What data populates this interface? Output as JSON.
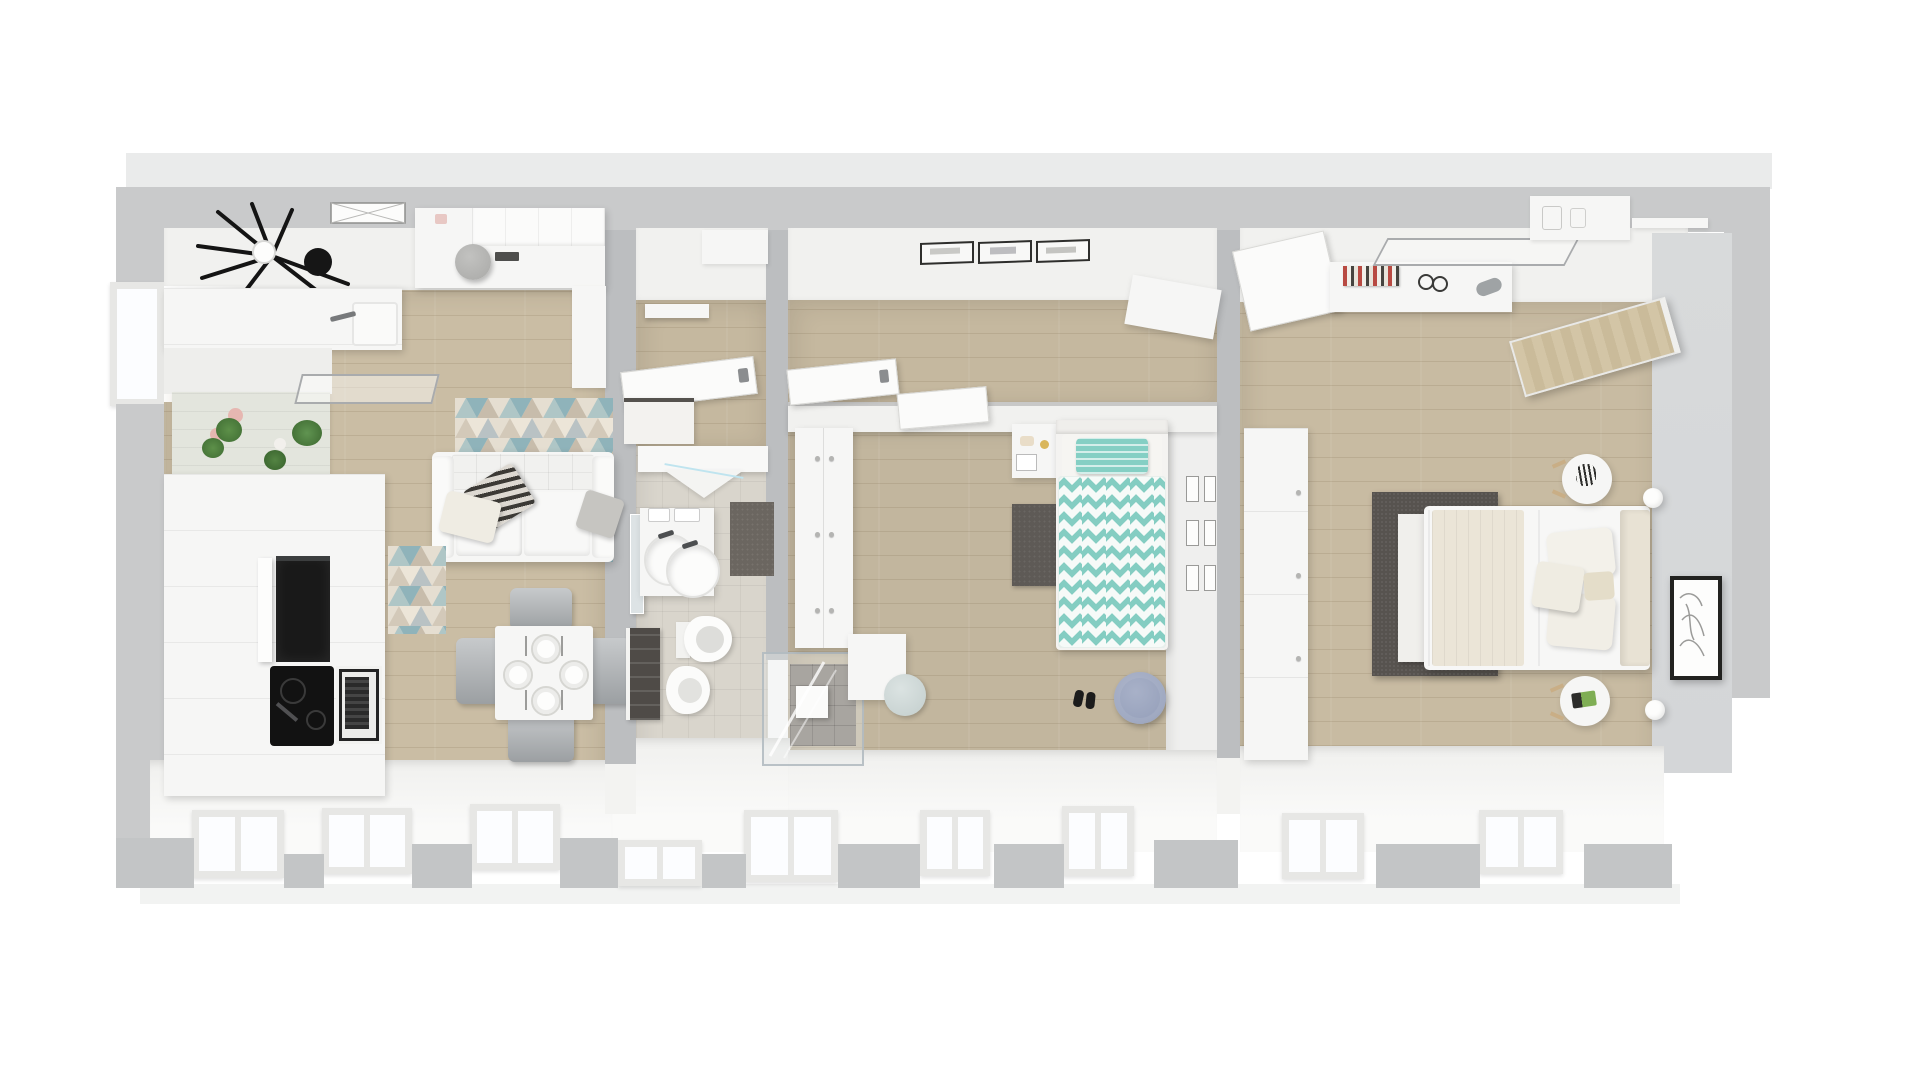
{
  "scene": {
    "kind": "3d-floorplan-top-view-render",
    "style": "scandinavian-apartment",
    "rooms": [
      {
        "name": "living-room-kitchen",
        "floor": "light-oak",
        "furniture": [
          "ceiling-fan",
          "ceiling-vent",
          "media-sideboard",
          "desk-pouf",
          "kitchen-counter",
          "kitchen-sink",
          "faucet",
          "plant-wall",
          "cooker-hood",
          "tall-kitchen-unit",
          "built-in-oven",
          "cooktop",
          "microwave",
          "geometric-triangle-rug",
          "sofa",
          "throw-pillows",
          "triangle-door-mat",
          "dining-table",
          "table-settings",
          "dining-chairs",
          "window-curtain"
        ]
      },
      {
        "name": "entry-hall",
        "floor": "light-oak",
        "furniture": [
          "wall-shelf",
          "open-entry-door",
          "shoe-bench"
        ]
      },
      {
        "name": "bathroom",
        "floor": "beige-tile",
        "furniture": [
          "shower-screen",
          "vanity-cabinet",
          "mirror-door",
          "round-basins",
          "bath-mat",
          "wall-hung-toilet",
          "bidet",
          "towel-rack",
          "walk-in-shower",
          "shower-head"
        ]
      },
      {
        "name": "hallway",
        "floor": "light-oak",
        "furniture": [
          "picture-frames",
          "open-door-leaf",
          "tilted-shelf"
        ]
      },
      {
        "name": "kids-bedroom",
        "floor": "light-oak",
        "furniture": [
          "wardrobe",
          "study-desk",
          "single-bed",
          "chevron-duvet",
          "striped-pillow",
          "dark-rug",
          "floor-pouf",
          "slippers",
          "gallery-frames",
          "play-table",
          "kids-chair"
        ]
      },
      {
        "name": "master-bedroom",
        "floor": "light-oak",
        "furniture": [
          "open-door-leaf",
          "book-shelf",
          "glass-shelf",
          "wood-door-panel",
          "wardrobe",
          "double-bed",
          "cream-blanket",
          "pillows",
          "headboard",
          "dark-rug",
          "round-nightstand-plant",
          "round-nightstand-books",
          "wall-lamps",
          "framed-artwork",
          "floating-shelf"
        ]
      }
    ],
    "window_count": 10
  },
  "colors": {
    "bg": "#ffffff",
    "exterior_wall": "#c9cacb",
    "pier": "#c3c5c6",
    "wall_core": "#bcbec0",
    "wall_face": "#f1f1ef",
    "floor_living": "#cabda4",
    "floor_hall": "#c5b89f",
    "floor_kids": "#c2b69e",
    "floor_master": "#c8bba2",
    "tile_bath": "#d9d5cc",
    "plank_line": "rgba(115,95,65,0.16)",
    "platform": "#f0f0ee",
    "window_glass": "#fcfdff",
    "window_frame": "#e7e7e5",
    "furniture_white": "#f6f6f5",
    "appliance_black": "#191919",
    "steel": "#a6aaac",
    "rug_dark": "#57534f",
    "rug_kids": "#5e5a56",
    "teal": "#85cfc4",
    "pouf_blue": "#98a2bc",
    "chair_gray": "#a9adb0",
    "accent_wall": "#d4d6d8",
    "plant_green": "#4d7f3e",
    "pot_pink": "#e6b7b1",
    "wood_door": "#cfc1a1",
    "cream": "#ebe5d7",
    "towel_dark": "#4f4b47",
    "mirror": "#dde3e5",
    "art_line": "#9b9b99"
  }
}
